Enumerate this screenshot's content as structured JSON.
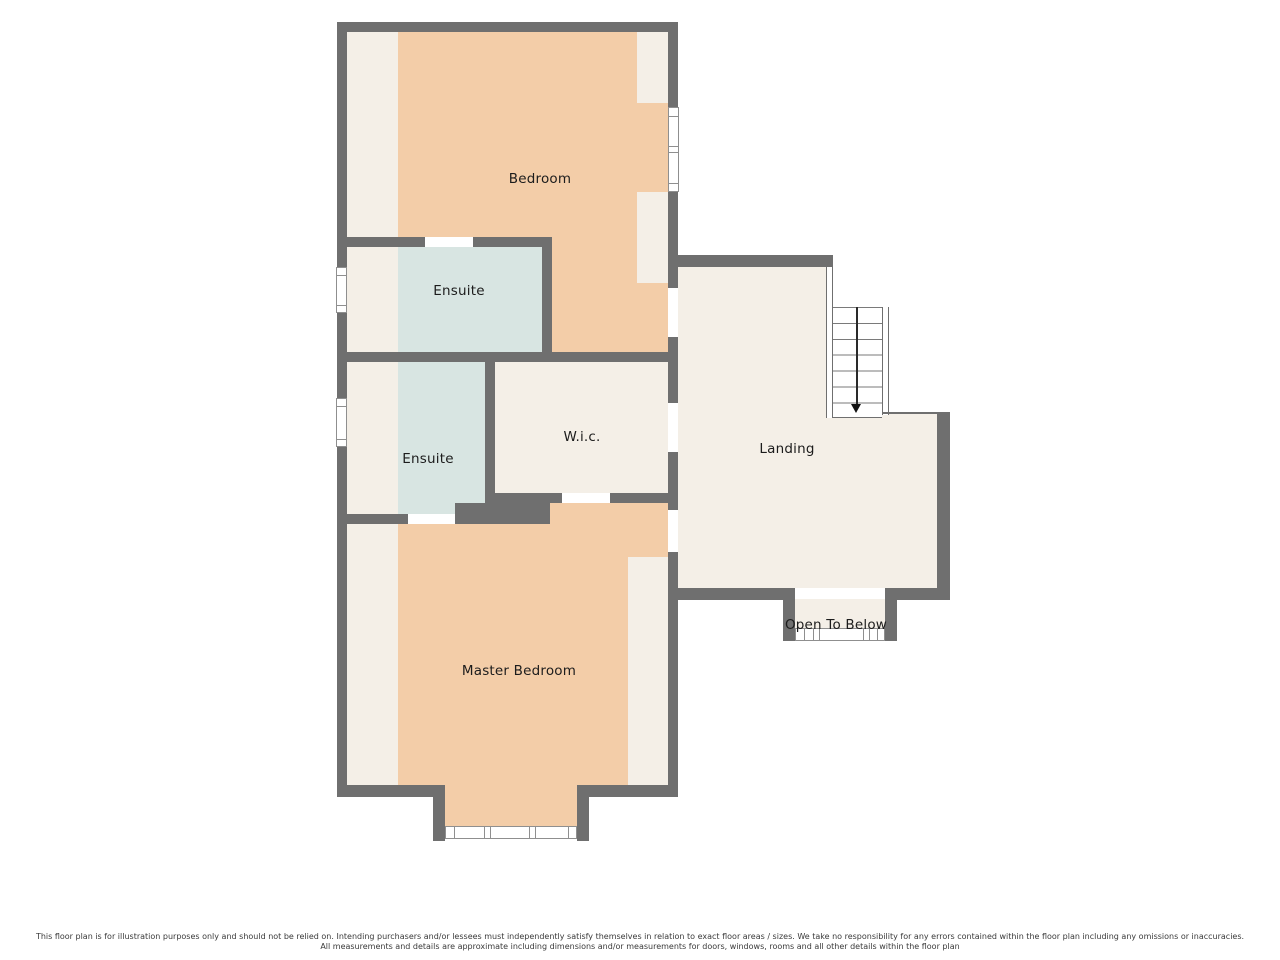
{
  "rooms": {
    "bedroom": "Bedroom",
    "ensuite_upper": "Ensuite",
    "ensuite_lower": "Ensuite",
    "wic": "W.i.c.",
    "landing": "Landing",
    "master_bedroom": "Master Bedroom",
    "open_to_below": "Open To Below"
  },
  "stairs": {
    "treads": 7,
    "direction_arrow": "down"
  },
  "colors": {
    "wall": "#6F6F6F",
    "floor_peach": "#F3CDA8",
    "floor_cream": "#F4EFE7",
    "floor_blue": "#D8E5E2",
    "background": "#FFFFFF"
  },
  "disclaimer": {
    "line1": "This floor plan is for illustration purposes only and should not be relied on. Intending purchasers and/or lessees must independently satisfy themselves in relation to exact floor areas / sizes. We take no responsibility for any errors contained within the floor plan including any omissions or inaccuracies.",
    "line2": "All measurements and details are approximate including dimensions and/or measurements for doors, windows, rooms and all other details within the floor plan"
  }
}
